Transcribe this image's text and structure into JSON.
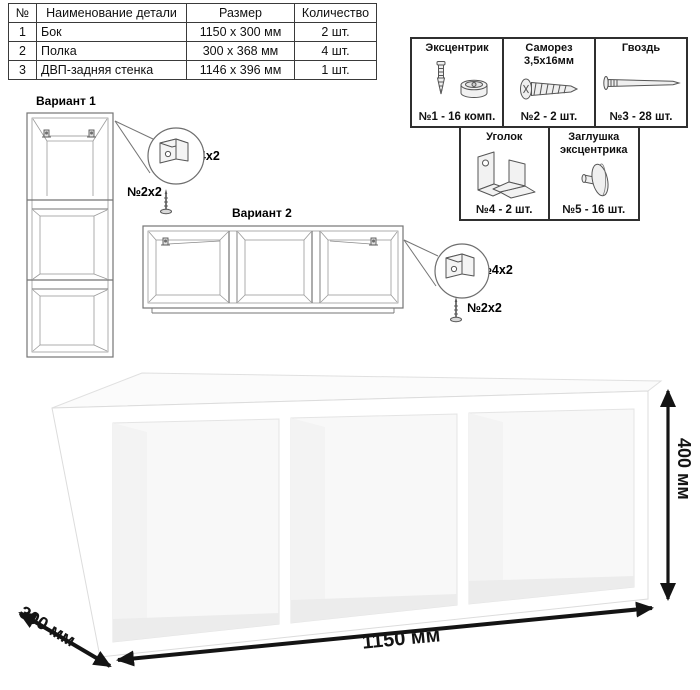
{
  "parts_table": {
    "headers": {
      "num": "№",
      "name": "Наименование детали",
      "size": "Размер",
      "qty": "Количество"
    },
    "rows": [
      {
        "num": "1",
        "name": "Бок",
        "size": "1150 x 300 мм",
        "qty": "2 шт."
      },
      {
        "num": "2",
        "name": "Полка",
        "size": "300 x 368 мм",
        "qty": "4 шт."
      },
      {
        "num": "3",
        "name": "ДВП-задняя стенка",
        "size": "1146 x 396 мм",
        "qty": "1 шт."
      }
    ]
  },
  "hardware": {
    "items": [
      {
        "name": "Эксцентрик",
        "count": "№1 - 16 комп.",
        "icon": "cam-and-dowel-icon"
      },
      {
        "name": "Саморез 3,5х16мм",
        "count": "№2 - 2 шт.",
        "icon": "screw-icon"
      },
      {
        "name": "Гвоздь",
        "count": "№3 - 28 шт.",
        "icon": "nail-icon"
      },
      {
        "name": "Уголок",
        "count": "№4 - 2 шт.",
        "icon": "corner-bracket-icon"
      },
      {
        "name": "Заглушка эксцентрика",
        "count": "№5 - 16 шт.",
        "icon": "cam-cap-icon"
      }
    ]
  },
  "variants": {
    "variant1": {
      "title": "Вариант 1",
      "bracket_label": "№4х2",
      "screw_label": "№2х2"
    },
    "variant2": {
      "title": "Вариант 2",
      "bracket_label": "№4х2",
      "screw_label": "№2х2"
    }
  },
  "dimensions": {
    "width": "1150 мм",
    "height": "400 мм",
    "depth": "300 мм"
  },
  "colors": {
    "line_art": "#6e6e6e",
    "dimension": "#141414",
    "panel_border": "#2f2f2f",
    "table_border": "#3a3a3a"
  }
}
